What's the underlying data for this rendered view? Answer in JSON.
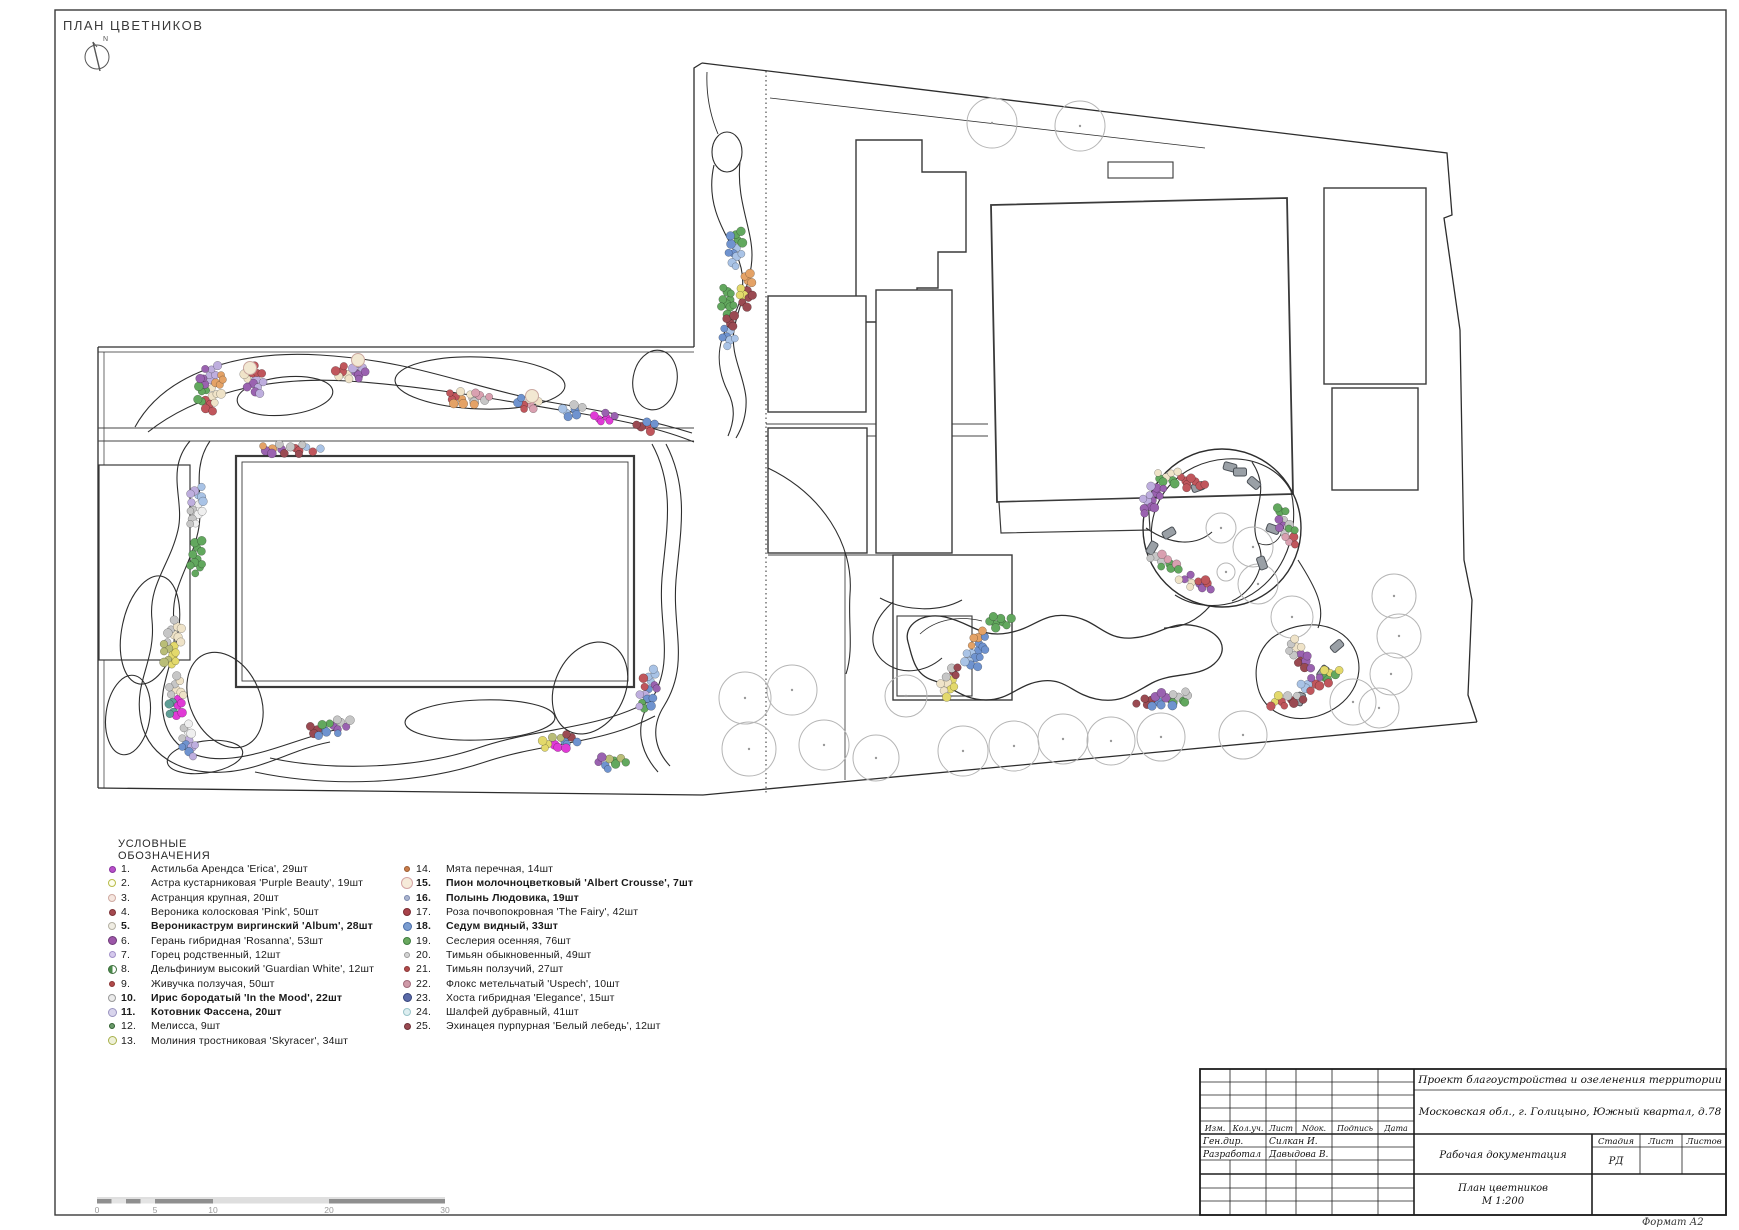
{
  "page": {
    "title": "ПЛАН ЦВЕТНИКОВ",
    "north_label": "N",
    "format_label": "Формат А2"
  },
  "legend": {
    "title": "УСЛОВНЫЕ ОБОЗНАЧЕНИЯ",
    "items": [
      {
        "n": "1.",
        "label": "Астильба Арендса 'Erica', 29шт",
        "bold": false,
        "m": {
          "f": "#b84fc9",
          "r": "#8a35a0",
          "s": 7
        }
      },
      {
        "n": "2.",
        "label": "Астра кустарниковая 'Purple Beauty', 19шт",
        "bold": false,
        "m": {
          "f": "#fdfdec",
          "r": "#b8bc4a",
          "s": 8
        }
      },
      {
        "n": "3.",
        "label": "Астранция крупная, 20шт",
        "bold": false,
        "m": {
          "f": "#f5e6df",
          "r": "#cfaaa2",
          "s": 8
        }
      },
      {
        "n": "4.",
        "label": "Вероника колосковая 'Pink', 50шт",
        "bold": false,
        "m": {
          "f": "#a5494f",
          "r": "#7d3338",
          "s": 7
        }
      },
      {
        "n": "5.",
        "label": "Вероникаструм виргинский 'Album', 28шт",
        "bold": true,
        "m": {
          "f": "#f0ede3",
          "r": "#b5b1a4",
          "s": 8
        }
      },
      {
        "n": "6.",
        "label": "Герань гибридная 'Rosanna', 53шт",
        "bold": false,
        "m": {
          "f": "#9c56a8",
          "r": "#6e3a78",
          "s": 9
        }
      },
      {
        "n": "7.",
        "label": "Горец родственный, 12шт",
        "bold": false,
        "m": {
          "f": "#d5c9ec",
          "r": "#a392c9",
          "s": 7
        }
      },
      {
        "n": "8.",
        "label": "Дельфиниум высокий 'Guardian White', 12шт",
        "bold": false,
        "m": {
          "f": "#ffffff",
          "r": "#3f6f3f",
          "s": 9,
          "split": "#4a8a4a"
        }
      },
      {
        "n": "9.",
        "label": "Живучка ползучая, 50шт",
        "bold": false,
        "m": {
          "f": "#b04a4a",
          "r": "#8a3535",
          "s": 6
        }
      },
      {
        "n": "10.",
        "label": "Ирис бородатый 'In the Mood', 22шт",
        "bold": true,
        "m": {
          "f": "#ebebeb",
          "r": "#9a9a9a",
          "s": 8
        }
      },
      {
        "n": "11.",
        "label": "Котовник Фассена, 20шт",
        "bold": true,
        "m": {
          "f": "#d8d4ec",
          "r": "#9a94c0",
          "s": 9
        }
      },
      {
        "n": "12.",
        "label": "Мелисса, 9шт",
        "bold": false,
        "m": {
          "f": "#6a9a6a",
          "r": "#2f5f2f",
          "s": 6
        }
      },
      {
        "n": "13.",
        "label": "Молиния тростниковая 'Skyracer', 34шт",
        "bold": false,
        "m": {
          "f": "#eef0d8",
          "r": "#a7b04a",
          "s": 9
        }
      },
      {
        "n": "14.",
        "label": "Мята перечная, 14шт",
        "bold": false,
        "m": {
          "f": "#c97c4a",
          "r": "#9a5a30",
          "s": 6
        }
      },
      {
        "n": "15.",
        "label": "Пион молочноцветковый 'Albert Crousse', 7шт",
        "bold": true,
        "m": {
          "f": "#f6ead9",
          "r": "#d4a4a4",
          "s": 12
        }
      },
      {
        "n": "16.",
        "label": "Полынь Людовика, 19шт",
        "bold": true,
        "m": {
          "f": "#aab4cf",
          "r": "#7a87ad",
          "s": 6
        }
      },
      {
        "n": "17.",
        "label": "Роза почвопокровная 'The Fairy', 42шт",
        "bold": false,
        "m": {
          "f": "#a8424a",
          "r": "#7a2d33",
          "s": 8
        }
      },
      {
        "n": "18.",
        "label": "Седум видный, 33шт",
        "bold": true,
        "m": {
          "f": "#7a9cd0",
          "r": "#4a6da8",
          "s": 9
        }
      },
      {
        "n": "19.",
        "label": "Сеслерия осенняя, 76шт",
        "bold": false,
        "m": {
          "f": "#6aa85f",
          "r": "#3f7d3f",
          "s": 8
        }
      },
      {
        "n": "20.",
        "label": "Тимьян обыкновенный, 49шт",
        "bold": false,
        "m": {
          "f": "#d4d4d4",
          "r": "#9a9a9a",
          "s": 6
        }
      },
      {
        "n": "21.",
        "label": "Тимьян ползучий, 27шт",
        "bold": false,
        "m": {
          "f": "#b04a4a",
          "r": "#8a3535",
          "s": 6
        }
      },
      {
        "n": "22.",
        "label": "Флокс метельчатый 'Uspech', 10шт",
        "bold": false,
        "m": {
          "f": "#cf9aa8",
          "r": "#a06a7a",
          "s": 8
        }
      },
      {
        "n": "23.",
        "label": "Хоста гибридная 'Elegance', 15шт",
        "bold": false,
        "m": {
          "f": "#5a6aa8",
          "r": "#35437a",
          "s": 9
        }
      },
      {
        "n": "24.",
        "label": "Шалфей дубравный, 41шт",
        "bold": false,
        "m": {
          "f": "#ddeef0",
          "r": "#9ac4c9",
          "s": 8
        }
      },
      {
        "n": "25.",
        "label": "Эхинацея пурпурная 'Белый лебедь', 12шт",
        "bold": false,
        "m": {
          "f": "#9a4a52",
          "r": "#6e3138",
          "s": 7
        }
      }
    ]
  },
  "scalebar": {
    "labels": [
      "0",
      "5",
      "10",
      "20",
      "30"
    ],
    "positions": [
      0,
      5,
      10,
      20,
      30
    ],
    "max": 30
  },
  "titleblock": {
    "project": "Проект благоустройства и озеленения территории",
    "address": "Московская обл., г. Голицыно, Южный квартал, д.78",
    "col_izm": "Изм.",
    "col_koluch": "Кол.уч.",
    "col_list": "Лист",
    "col_ndok": "Nдок.",
    "col_podpis": "Подпись",
    "col_data": "Дата",
    "row1_role": "Ген.дир.",
    "row1_name": "Силкан И.",
    "row2_role": "Разработал",
    "row2_name": "Давыдова В.",
    "doc_type": "Рабочая документация",
    "stage_label": "Стадия",
    "sheet_label": "Лист",
    "sheets_label": "Листов",
    "stage_value": "РД",
    "drawing_name": "План цветников",
    "drawing_scale": "М 1:200"
  },
  "plan": {
    "palette": {
      "cream": "#efe3c8",
      "red": "#c0565c",
      "maroon": "#9a4a52",
      "green": "#62a85e",
      "purple": "#9a62b0",
      "lavender": "#beaede",
      "orange": "#e4a266",
      "blue": "#6f93cf",
      "lightblue": "#a9c3e6",
      "magenta": "#e03ad6",
      "yellow": "#e3d96b",
      "olive": "#b9bd77",
      "gray": "#c6c6c6",
      "white": "#efefef",
      "pink": "#d9a0b0",
      "teal": "#5f9e96"
    },
    "clusters": [
      {
        "x": 210,
        "y": 388,
        "w": 26,
        "h": 52,
        "rot": 10,
        "colors": [
          "cream",
          "red",
          "green",
          "purple",
          "lavender",
          "orange"
        ]
      },
      {
        "x": 254,
        "y": 380,
        "w": 20,
        "h": 36,
        "rot": -15,
        "colors": [
          "lavender",
          "purple",
          "cream",
          "red"
        ]
      },
      {
        "x": 352,
        "y": 372,
        "w": 36,
        "h": 18,
        "rot": -8,
        "colors": [
          "purple",
          "cream",
          "red",
          "lavender"
        ]
      },
      {
        "x": 468,
        "y": 398,
        "w": 46,
        "h": 16,
        "rot": 4,
        "colors": [
          "gray",
          "orange",
          "red",
          "cream",
          "pink"
        ]
      },
      {
        "x": 528,
        "y": 404,
        "w": 30,
        "h": 14,
        "rot": 6,
        "colors": [
          "pink",
          "red",
          "blue",
          "cream"
        ]
      },
      {
        "x": 572,
        "y": 410,
        "w": 26,
        "h": 14,
        "rot": 6,
        "colors": [
          "blue",
          "lightblue",
          "gray"
        ]
      },
      {
        "x": 604,
        "y": 417,
        "w": 26,
        "h": 13,
        "rot": 8,
        "colors": [
          "magenta",
          "magenta",
          "purple"
        ]
      },
      {
        "x": 645,
        "y": 426,
        "w": 22,
        "h": 12,
        "rot": 8,
        "colors": [
          "red",
          "maroon",
          "blue"
        ]
      },
      {
        "x": 290,
        "y": 449,
        "w": 66,
        "h": 11,
        "rot": 1,
        "colors": [
          "red",
          "maroon",
          "purple",
          "orange",
          "gray",
          "lightblue"
        ]
      },
      {
        "x": 196,
        "y": 505,
        "w": 16,
        "h": 46,
        "rot": 5,
        "colors": [
          "white",
          "gray",
          "lavender",
          "lightblue"
        ]
      },
      {
        "x": 197,
        "y": 558,
        "w": 14,
        "h": 40,
        "rot": 3,
        "colors": [
          "green",
          "green"
        ]
      },
      {
        "x": 172,
        "y": 645,
        "w": 18,
        "h": 54,
        "rot": 10,
        "colors": [
          "yellow",
          "olive",
          "gray",
          "cream"
        ]
      },
      {
        "x": 176,
        "y": 698,
        "w": 18,
        "h": 46,
        "rot": 5,
        "colors": [
          "magenta",
          "teal",
          "gray",
          "cream"
        ]
      },
      {
        "x": 188,
        "y": 740,
        "w": 16,
        "h": 36,
        "rot": -8,
        "colors": [
          "lavender",
          "blue",
          "gray",
          "white"
        ]
      },
      {
        "x": 330,
        "y": 727,
        "w": 46,
        "h": 16,
        "rot": -12,
        "colors": [
          "purple",
          "blue",
          "maroon",
          "green",
          "gray"
        ]
      },
      {
        "x": 560,
        "y": 742,
        "w": 42,
        "h": 16,
        "rot": -10,
        "colors": [
          "blue",
          "magenta",
          "yellow",
          "olive",
          "maroon"
        ]
      },
      {
        "x": 648,
        "y": 690,
        "w": 18,
        "h": 46,
        "rot": 15,
        "colors": [
          "blue",
          "green",
          "lavender",
          "red",
          "lightblue",
          "purple"
        ]
      },
      {
        "x": 610,
        "y": 762,
        "w": 32,
        "h": 14,
        "rot": -8,
        "colors": [
          "green",
          "blue",
          "purple",
          "olive"
        ]
      },
      {
        "x": 736,
        "y": 248,
        "w": 16,
        "h": 42,
        "rot": 10,
        "colors": [
          "lightblue",
          "blue",
          "green"
        ]
      },
      {
        "x": 746,
        "y": 290,
        "w": 16,
        "h": 38,
        "rot": 5,
        "colors": [
          "maroon",
          "yellow",
          "orange"
        ]
      },
      {
        "x": 728,
        "y": 300,
        "w": 14,
        "h": 34,
        "rot": -5,
        "colors": [
          "green",
          "green"
        ]
      },
      {
        "x": 729,
        "y": 332,
        "w": 14,
        "h": 38,
        "rot": 5,
        "colors": [
          "lightblue",
          "blue",
          "maroon"
        ]
      },
      {
        "x": 1180,
        "y": 480,
        "w": 58,
        "h": 14,
        "rot": 12,
        "colors": [
          "red",
          "green",
          "cream",
          "red"
        ]
      },
      {
        "x": 1152,
        "y": 499,
        "w": 18,
        "h": 36,
        "rot": 35,
        "colors": [
          "purple",
          "lavender",
          "purple"
        ]
      },
      {
        "x": 1166,
        "y": 562,
        "w": 34,
        "h": 14,
        "rot": 22,
        "colors": [
          "green",
          "gray",
          "pink"
        ]
      },
      {
        "x": 1196,
        "y": 583,
        "w": 38,
        "h": 14,
        "rot": 18,
        "colors": [
          "purple",
          "cream",
          "purple",
          "red"
        ]
      },
      {
        "x": 1283,
        "y": 520,
        "w": 14,
        "h": 36,
        "rot": -15,
        "colors": [
          "gray",
          "purple",
          "green"
        ]
      },
      {
        "x": 1291,
        "y": 537,
        "w": 12,
        "h": 26,
        "rot": -10,
        "colors": [
          "red",
          "pink",
          "green"
        ]
      },
      {
        "x": 1000,
        "y": 622,
        "w": 30,
        "h": 14,
        "rot": 0,
        "colors": [
          "green",
          "green"
        ]
      },
      {
        "x": 976,
        "y": 650,
        "w": 20,
        "h": 42,
        "rot": 25,
        "colors": [
          "blue",
          "lightblue",
          "orange",
          "blue"
        ]
      },
      {
        "x": 950,
        "y": 680,
        "w": 16,
        "h": 36,
        "rot": 20,
        "colors": [
          "yellow",
          "cream",
          "gray",
          "maroon"
        ]
      },
      {
        "x": 1165,
        "y": 700,
        "w": 58,
        "h": 16,
        "rot": -5,
        "colors": [
          "green",
          "blue",
          "maroon",
          "purple",
          "gray"
        ]
      },
      {
        "x": 1300,
        "y": 655,
        "w": 16,
        "h": 40,
        "rot": -30,
        "colors": [
          "purple",
          "maroon",
          "gray",
          "cream"
        ]
      },
      {
        "x": 1320,
        "y": 680,
        "w": 46,
        "h": 16,
        "rot": -25,
        "colors": [
          "green",
          "red",
          "lightblue",
          "purple",
          "yellow"
        ]
      },
      {
        "x": 1287,
        "y": 700,
        "w": 36,
        "h": 14,
        "rot": -10,
        "colors": [
          "maroon",
          "red",
          "yellow",
          "gray"
        ]
      }
    ],
    "big_dots": [
      {
        "x": 250,
        "y": 368
      },
      {
        "x": 358,
        "y": 360
      },
      {
        "x": 532,
        "y": 396
      }
    ],
    "trees": [
      {
        "x": 992,
        "y": 123,
        "r": 25
      },
      {
        "x": 1080,
        "y": 126,
        "r": 25
      },
      {
        "x": 1253,
        "y": 547,
        "r": 20
      },
      {
        "x": 1258,
        "y": 584,
        "r": 20
      },
      {
        "x": 1292,
        "y": 617,
        "r": 21
      },
      {
        "x": 1394,
        "y": 596,
        "r": 22
      },
      {
        "x": 1399,
        "y": 636,
        "r": 22
      },
      {
        "x": 1391,
        "y": 674,
        "r": 21
      },
      {
        "x": 1379,
        "y": 708,
        "r": 20
      },
      {
        "x": 745,
        "y": 698,
        "r": 26
      },
      {
        "x": 792,
        "y": 690,
        "r": 25
      },
      {
        "x": 749,
        "y": 749,
        "r": 27
      },
      {
        "x": 824,
        "y": 745,
        "r": 25
      },
      {
        "x": 876,
        "y": 758,
        "r": 23
      },
      {
        "x": 906,
        "y": 696,
        "r": 21
      },
      {
        "x": 963,
        "y": 751,
        "r": 25
      },
      {
        "x": 1014,
        "y": 746,
        "r": 25
      },
      {
        "x": 1063,
        "y": 739,
        "r": 25
      },
      {
        "x": 1111,
        "y": 741,
        "r": 24
      },
      {
        "x": 1161,
        "y": 737,
        "r": 24
      },
      {
        "x": 1243,
        "y": 735,
        "r": 24
      },
      {
        "x": 1353,
        "y": 702,
        "r": 23
      },
      {
        "x": 1221,
        "y": 528,
        "r": 15
      },
      {
        "x": 1226,
        "y": 572,
        "r": 9
      }
    ],
    "stones": [
      {
        "x": 1198,
        "y": 487,
        "rot": -20
      },
      {
        "x": 1230,
        "y": 467,
        "rot": 15
      },
      {
        "x": 1254,
        "y": 483,
        "rot": 40
      },
      {
        "x": 1169,
        "y": 533,
        "rot": -30
      },
      {
        "x": 1152,
        "y": 548,
        "rot": -60
      },
      {
        "x": 1273,
        "y": 529,
        "rot": 20
      },
      {
        "x": 1262,
        "y": 563,
        "rot": 70
      },
      {
        "x": 1240,
        "y": 472,
        "rot": 0
      },
      {
        "x": 1337,
        "y": 646,
        "rot": -40
      },
      {
        "x": 1323,
        "y": 672,
        "rot": -55
      },
      {
        "x": 1300,
        "y": 699,
        "rot": -70
      }
    ]
  }
}
